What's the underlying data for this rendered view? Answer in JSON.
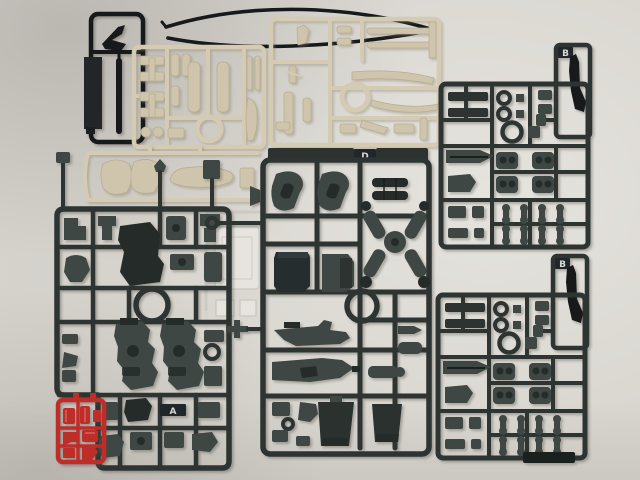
{
  "scene": {
    "description": "Photograph of plastic model-kit runners (sprues) laid out on a pale table: cream runners upper left, dark grey-green runners A, D and two B runners, a small red runner, a black antenna runner and a black wire, plus a faint clear-parts runner"
  },
  "sprues": {
    "left_dark": {
      "letter": "A"
    },
    "center_dark": {
      "letter": "D"
    },
    "right_top_dark": {
      "letter": "B"
    },
    "right_bottom_dark": {
      "letter": "B"
    }
  },
  "colors": {
    "bg": "#d9d6d0",
    "dark": "#2d3432",
    "dark_part": "#3e4743",
    "dark_deep": "#252b29",
    "cream": "#d5cbb3",
    "cream_part": "#cfc5ac",
    "cream_edge": "#b9ae92",
    "black": "#17191a",
    "tab": "#20262a",
    "letter": "#d8d8d2",
    "red": "#bf2d28",
    "red_dark": "#9c201e",
    "clear": "#e9e6e1",
    "clear_edge": "#c6c3bd"
  }
}
